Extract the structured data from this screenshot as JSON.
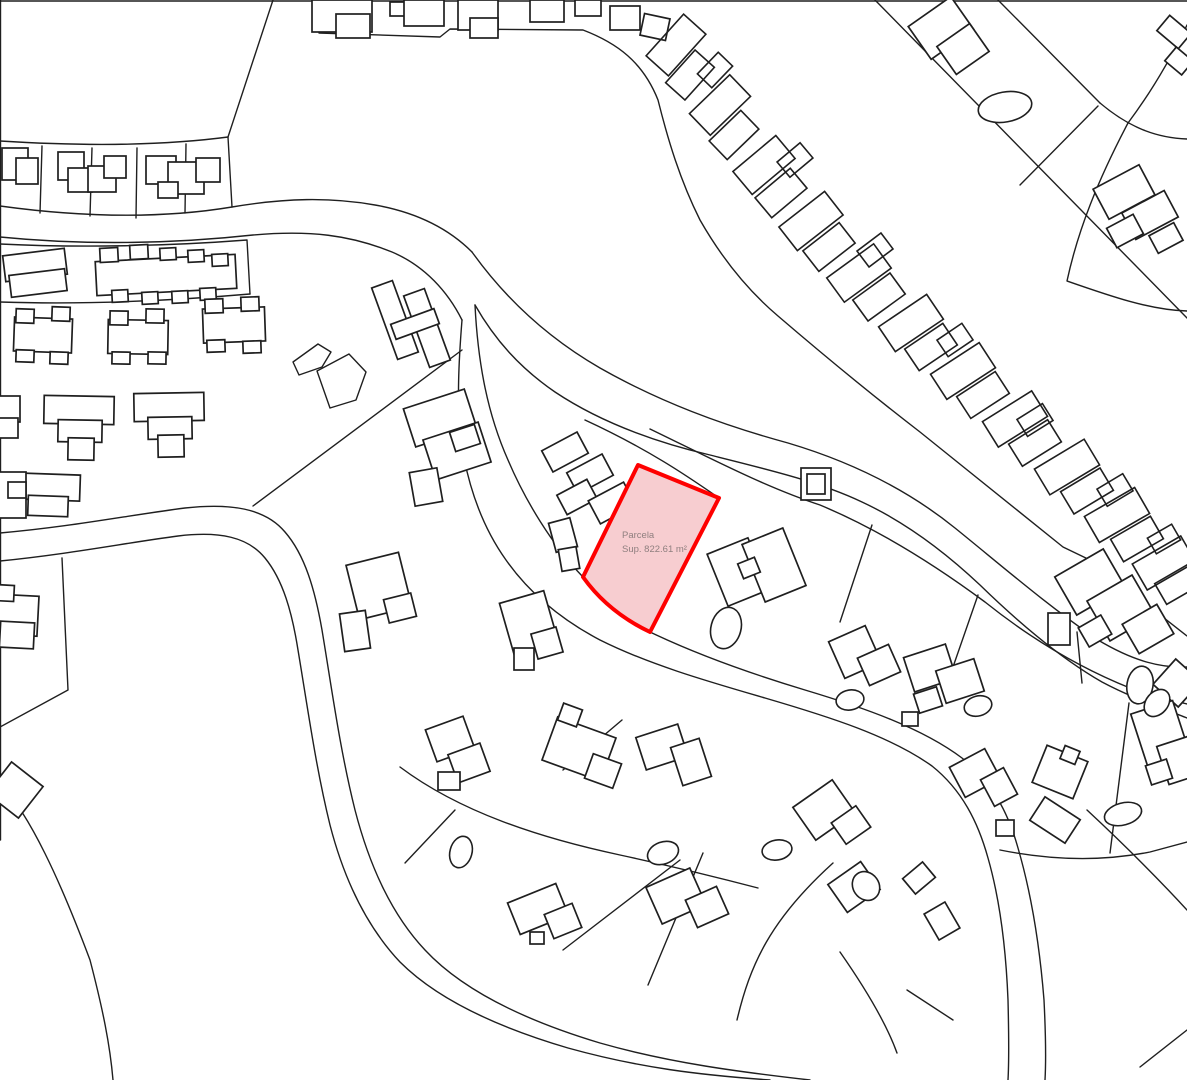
{
  "map": {
    "background": "#ffffff",
    "line_color": "#1f1f1f",
    "building_fill": "#ffffff",
    "parcel": {
      "path": "M638,465 L719,498 L650,632 Q608,612 583,577 Z",
      "fill": "#f7cdd0",
      "stroke": "#fe0000",
      "stroke_width": 4,
      "label": {
        "line1": "Parcela",
        "line2": "Sup. 822.61 m²",
        "color": "#8f7f7f"
      }
    },
    "boundaries": [
      "M0,1 L1187,1",
      "M0.5,0 L0.5,840",
      "M273,0 L228,137",
      "M0,141 C80,146 160,146 228,137 L232,207",
      "M42,146 L40,213",
      "M92,148 L90,216",
      "M137,148 L136,218",
      "M186,144 L185,213",
      "M0,206 C80,217 160,219 232,207 C285,198 330,197 375,205 C420,213 450,230 472,252",
      "M0,237 C90,246 180,243 253,235 C310,230 350,235 392,252 C425,266 448,292 462,320",
      "M0,244 C80,248 170,246 247,240 L250,294",
      "M0,302 C90,305 180,300 250,294",
      "M472,252 C505,298 548,338 600,368 C660,402 722,425 788,443 C852,462 908,490 955,528 C1002,566 1048,606 1098,640 C1135,662 1162,668 1187,667",
      "M475,305 C495,340 520,368 555,392 C600,422 655,442 710,455 C770,470 820,482 862,502 C905,522 945,552 980,585 C1018,622 1060,658 1102,682 C1132,698 1162,708 1187,718",
      "M475,305 C478,365 488,415 508,460 C525,500 552,545 583,577",
      "M650,632 C700,656 752,674 805,690 C865,708 922,728 962,758 C992,782 1008,812 1018,848 C1032,896 1040,950 1044,1000 C1046,1040 1046,1062 1045,1080",
      "M462,320 C458,370 456,415 464,458 C472,498 486,532 506,560 C530,594 562,620 600,640 C650,665 710,682 765,698 C830,717 890,736 932,766 C962,790 978,822 988,858 C1000,900 1006,950 1008,1000 C1009,1040 1009,1062 1008,1080",
      "M0,533 C70,527 130,515 185,508 C230,503 265,508 285,532 C305,555 315,590 322,630 C332,690 340,750 355,810 C370,868 392,915 425,950 C465,993 530,1022 600,1043 C670,1063 740,1072 810,1080",
      "M0,561 C70,554 125,543 178,536 C220,531 248,537 265,558 C283,580 292,612 298,650 C308,710 316,768 330,825 C345,883 368,928 400,962 C438,1000 500,1028 568,1048 C640,1068 700,1075 770,1080",
      "M253,506 L462,350",
      "M62,558 L68,690 L0,727",
      "M0,783 C30,815 60,880 90,960 C103,1010 110,1045 113,1080",
      "M318,2 L319,33 L440,37 L450,29 L583,30 C617,43 643,62 658,100 C668,140 680,180 700,220 C720,255 745,288 778,316 C820,352 868,392 920,432 L1063,547 L1090,560 L1187,636",
      "M875,0 L1187,318",
      "M1020,185 L1098,106",
      "M998,0 L1100,103",
      "M1100,103 C1132,130 1160,138 1187,139",
      "M1187,25 C1170,60 1149,95 1128,123",
      "M1128,123 C1098,180 1078,230 1067,281 C1110,296 1150,310 1187,311",
      "M585,420 C650,450 690,478 719,498",
      "M650,429 C710,458 765,487 820,505 C880,530 935,565 985,602 C1030,638 1080,668 1130,688 C1150,695 1170,700 1187,704",
      "M872,525 L840,622",
      "M978,595 L945,690",
      "M455,810 L405,863",
      "M563,770 L622,720",
      "M648,985 L703,853",
      "M563,950 L680,860",
      "M737,1020 C750,965 770,920 833,863",
      "M840,952 C870,995 888,1028 897,1053",
      "M907,990 L953,1020",
      "M400,767 C460,812 540,838 620,855 C680,868 720,878 758,888",
      "M1077,632 L1082,683",
      "M1129,703 L1110,853",
      "M1000,850 C1060,862 1110,860 1150,852 L1187,842",
      "M1087,810 C1130,850 1164,885 1187,910",
      "M1140,1067 L1187,1030",
      "M293,362 L318,344 L331,352 L322,367 L299,375 Z",
      "M317,371 L349,354 L366,372 L356,400 L330,408 Z"
    ],
    "buildings": [
      [
        312,
        0,
        60,
        32,
        0
      ],
      [
        336,
        14,
        34,
        24,
        0
      ],
      [
        390,
        2,
        16,
        14,
        0
      ],
      [
        404,
        0,
        40,
        26,
        0
      ],
      [
        458,
        0,
        40,
        30,
        0
      ],
      [
        470,
        18,
        28,
        20,
        0
      ],
      [
        530,
        0,
        34,
        22,
        0
      ],
      [
        575,
        0,
        26,
        16,
        0
      ],
      [
        610,
        6,
        30,
        24,
        0
      ],
      [
        642,
        16,
        26,
        22,
        12
      ],
      [
        915,
        8,
        52,
        40,
        -35
      ],
      [
        943,
        32,
        40,
        34,
        -35
      ],
      [
        1160,
        22,
        28,
        20,
        40
      ],
      [
        1168,
        52,
        22,
        18,
        40
      ],
      [
        1098,
        175,
        52,
        34,
        -28
      ],
      [
        1126,
        200,
        48,
        30,
        -28
      ],
      [
        1110,
        220,
        30,
        22,
        -28
      ],
      [
        1152,
        228,
        28,
        20,
        -28
      ],
      [
        648,
        30,
        56,
        30,
        -48,
        1
      ],
      [
        668,
        62,
        44,
        26,
        -48,
        1
      ],
      [
        692,
        90,
        56,
        30,
        -44,
        1
      ],
      [
        712,
        122,
        44,
        26,
        -44,
        1
      ],
      [
        736,
        150,
        56,
        30,
        -40,
        1
      ],
      [
        758,
        180,
        46,
        26,
        -40,
        1
      ],
      [
        782,
        206,
        58,
        30,
        -38,
        1
      ],
      [
        806,
        234,
        46,
        26,
        -38,
        1
      ],
      [
        830,
        258,
        58,
        30,
        -36,
        1
      ],
      [
        856,
        284,
        46,
        26,
        -36,
        1
      ],
      [
        882,
        308,
        58,
        30,
        -34,
        1
      ],
      [
        908,
        334,
        46,
        26,
        -34,
        1
      ],
      [
        934,
        356,
        58,
        30,
        -33,
        1
      ],
      [
        960,
        382,
        46,
        26,
        -33,
        1
      ],
      [
        986,
        404,
        58,
        30,
        -32,
        1
      ],
      [
        1012,
        430,
        46,
        26,
        -32,
        1
      ],
      [
        1038,
        452,
        58,
        30,
        -31,
        1
      ],
      [
        1064,
        478,
        46,
        26,
        -31,
        1
      ],
      [
        1088,
        500,
        58,
        30,
        -30,
        1
      ],
      [
        1114,
        526,
        46,
        26,
        -30,
        1
      ],
      [
        1136,
        548,
        56,
        30,
        -30,
        1
      ],
      [
        1158,
        572,
        40,
        24,
        -30,
        1
      ],
      [
        700,
        60,
        30,
        20,
        -46,
        1
      ],
      [
        780,
        150,
        30,
        20,
        -40,
        1
      ],
      [
        860,
        240,
        30,
        20,
        -37,
        1
      ],
      [
        940,
        330,
        30,
        20,
        -34,
        1
      ],
      [
        1020,
        410,
        30,
        20,
        -32,
        1
      ],
      [
        1100,
        480,
        30,
        20,
        -31,
        1
      ],
      [
        1150,
        530,
        28,
        18,
        -30,
        1
      ],
      [
        2,
        148,
        26,
        32,
        0
      ],
      [
        16,
        158,
        22,
        26,
        0
      ],
      [
        58,
        152,
        26,
        28,
        0
      ],
      [
        68,
        168,
        24,
        24,
        0
      ],
      [
        88,
        166,
        28,
        26,
        0
      ],
      [
        104,
        156,
        22,
        22,
        0
      ],
      [
        146,
        156,
        30,
        28,
        0
      ],
      [
        168,
        162,
        36,
        32,
        0
      ],
      [
        196,
        158,
        24,
        24,
        0
      ],
      [
        158,
        182,
        20,
        16,
        0
      ],
      [
        4,
        252,
        62,
        26,
        -7
      ],
      [
        10,
        272,
        56,
        22,
        -7
      ],
      [
        96,
        258,
        140,
        34,
        -3
      ],
      [
        100,
        248,
        18,
        14,
        -3
      ],
      [
        130,
        245,
        18,
        14,
        -3
      ],
      [
        160,
        248,
        16,
        12,
        -3
      ],
      [
        188,
        250,
        16,
        12,
        -3
      ],
      [
        212,
        254,
        16,
        12,
        -3
      ],
      [
        112,
        290,
        16,
        12,
        -3
      ],
      [
        142,
        292,
        16,
        12,
        -3
      ],
      [
        172,
        291,
        16,
        12,
        -3
      ],
      [
        200,
        288,
        16,
        12,
        -3
      ],
      [
        14,
        318,
        58,
        34,
        2
      ],
      [
        16,
        309,
        18,
        14,
        2
      ],
      [
        52,
        307,
        18,
        14,
        2
      ],
      [
        16,
        350,
        18,
        12,
        2
      ],
      [
        50,
        352,
        18,
        12,
        2
      ],
      [
        108,
        320,
        60,
        34,
        1
      ],
      [
        110,
        311,
        18,
        14,
        1
      ],
      [
        146,
        309,
        18,
        14,
        1
      ],
      [
        112,
        352,
        18,
        12,
        1
      ],
      [
        148,
        352,
        18,
        12,
        1
      ],
      [
        203,
        308,
        62,
        34,
        -2
      ],
      [
        205,
        299,
        18,
        14,
        -2
      ],
      [
        241,
        297,
        18,
        14,
        -2
      ],
      [
        207,
        340,
        18,
        12,
        -2
      ],
      [
        243,
        341,
        18,
        12,
        -2
      ],
      [
        44,
        396,
        70,
        28,
        1
      ],
      [
        58,
        420,
        44,
        22,
        1
      ],
      [
        68,
        438,
        26,
        22,
        1
      ],
      [
        134,
        393,
        70,
        28,
        -1
      ],
      [
        148,
        417,
        44,
        22,
        -1
      ],
      [
        158,
        435,
        26,
        22,
        -1
      ],
      [
        -18,
        396,
        38,
        26,
        0
      ],
      [
        -10,
        418,
        28,
        20,
        0
      ],
      [
        16,
        474,
        64,
        26,
        2
      ],
      [
        28,
        496,
        40,
        20,
        2
      ],
      [
        -10,
        472,
        36,
        46,
        0
      ],
      [
        8,
        482,
        18,
        16,
        0
      ],
      [
        -12,
        595,
        50,
        40,
        3
      ],
      [
        0,
        622,
        34,
        26,
        3
      ],
      [
        -6,
        585,
        20,
        16,
        3
      ],
      [
        -5,
        770,
        40,
        40,
        38
      ],
      [
        384,
        282,
        22,
        76,
        -20
      ],
      [
        416,
        290,
        22,
        76,
        -20
      ],
      [
        392,
        316,
        46,
        16,
        -20
      ],
      [
        408,
        398,
        64,
        40,
        -18
      ],
      [
        428,
        430,
        58,
        42,
        -18
      ],
      [
        412,
        470,
        28,
        34,
        -10
      ],
      [
        452,
        428,
        26,
        20,
        -18
      ],
      [
        545,
        440,
        40,
        24,
        -28
      ],
      [
        570,
        462,
        40,
        24,
        -28
      ],
      [
        560,
        486,
        34,
        22,
        -28
      ],
      [
        592,
        490,
        40,
        26,
        -28
      ],
      [
        612,
        516,
        34,
        22,
        -28
      ],
      [
        552,
        520,
        22,
        30,
        -15
      ],
      [
        560,
        548,
        18,
        22,
        -10
      ],
      [
        801,
        468,
        30,
        32,
        0
      ],
      [
        807,
        474,
        18,
        20,
        0
      ],
      [
        716,
        544,
        44,
        56,
        -22
      ],
      [
        752,
        534,
        44,
        62,
        -22
      ],
      [
        740,
        560,
        18,
        16,
        -22
      ],
      [
        835,
        632,
        40,
        40,
        -24
      ],
      [
        862,
        650,
        34,
        30,
        -24
      ],
      [
        908,
        650,
        44,
        36,
        -18
      ],
      [
        940,
        664,
        40,
        34,
        -18
      ],
      [
        916,
        690,
        24,
        20,
        -18
      ],
      [
        902,
        712,
        16,
        14,
        0
      ],
      [
        1062,
        560,
        56,
        44,
        -30
      ],
      [
        1095,
        585,
        52,
        46,
        -30
      ],
      [
        1128,
        612,
        40,
        34,
        -30
      ],
      [
        1082,
        620,
        26,
        22,
        -30
      ],
      [
        1048,
        613,
        22,
        32,
        0
      ],
      [
        1160,
        666,
        34,
        34,
        42
      ],
      [
        1038,
        752,
        44,
        40,
        22
      ],
      [
        1062,
        748,
        16,
        14,
        22
      ],
      [
        1034,
        806,
        42,
        28,
        33
      ],
      [
        1138,
        706,
        44,
        54,
        -18
      ],
      [
        1162,
        740,
        36,
        40,
        -18
      ],
      [
        1148,
        762,
        22,
        20,
        -18
      ],
      [
        352,
        558,
        54,
        56,
        -14
      ],
      [
        342,
        612,
        26,
        38,
        -8
      ],
      [
        386,
        596,
        28,
        24,
        -14
      ],
      [
        506,
        596,
        46,
        54,
        -16
      ],
      [
        534,
        630,
        26,
        26,
        -16
      ],
      [
        514,
        648,
        20,
        22,
        0
      ],
      [
        430,
        722,
        40,
        34,
        -20
      ],
      [
        452,
        748,
        34,
        30,
        -20
      ],
      [
        438,
        772,
        22,
        18,
        0
      ],
      [
        548,
        726,
        62,
        46,
        20
      ],
      [
        588,
        758,
        30,
        26,
        20
      ],
      [
        560,
        706,
        20,
        18,
        20
      ],
      [
        640,
        730,
        44,
        34,
        -18
      ],
      [
        676,
        742,
        30,
        40,
        -18
      ],
      [
        512,
        892,
        52,
        34,
        -22
      ],
      [
        548,
        908,
        30,
        26,
        -22
      ],
      [
        530,
        932,
        14,
        12,
        0
      ],
      [
        652,
        876,
        48,
        40,
        -24
      ],
      [
        690,
        892,
        34,
        30,
        -24
      ],
      [
        834,
        870,
        40,
        34,
        -35
      ],
      [
        906,
        868,
        26,
        20,
        -40
      ],
      [
        930,
        906,
        24,
        30,
        -30
      ],
      [
        800,
        790,
        48,
        40,
        -35
      ],
      [
        836,
        812,
        30,
        26,
        -35
      ],
      [
        955,
        756,
        40,
        34,
        -28
      ],
      [
        986,
        772,
        26,
        30,
        -28
      ],
      [
        996,
        820,
        18,
        16,
        0
      ]
    ],
    "pools": [
      [
        1005,
        107,
        27,
        15,
        -10
      ],
      [
        726,
        628,
        15,
        21,
        15
      ],
      [
        850,
        700,
        14,
        10,
        -10
      ],
      [
        461,
        852,
        11,
        16,
        15
      ],
      [
        663,
        853,
        16,
        11,
        -20
      ],
      [
        777,
        850,
        15,
        10,
        -10
      ],
      [
        866,
        886,
        13,
        15,
        -35
      ],
      [
        1140,
        685,
        13,
        19,
        10
      ],
      [
        1157,
        703,
        11,
        15,
        40
      ],
      [
        1123,
        814,
        19,
        11,
        -15
      ],
      [
        978,
        706,
        14,
        10,
        -15
      ]
    ]
  }
}
